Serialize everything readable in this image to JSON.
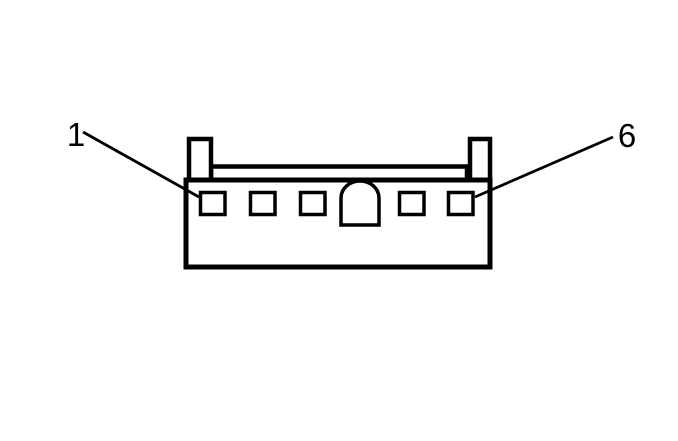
{
  "figure": {
    "type": "electrical-connector-face-view",
    "background_color": "#ffffff",
    "line_color": "#000000",
    "cavity_count": 6,
    "square_cavities": 5,
    "keyway_cavities": 1,
    "callouts": [
      {
        "label": "1",
        "points_to": "cavity-1"
      },
      {
        "label": "6",
        "points_to": "cavity-6"
      }
    ]
  }
}
